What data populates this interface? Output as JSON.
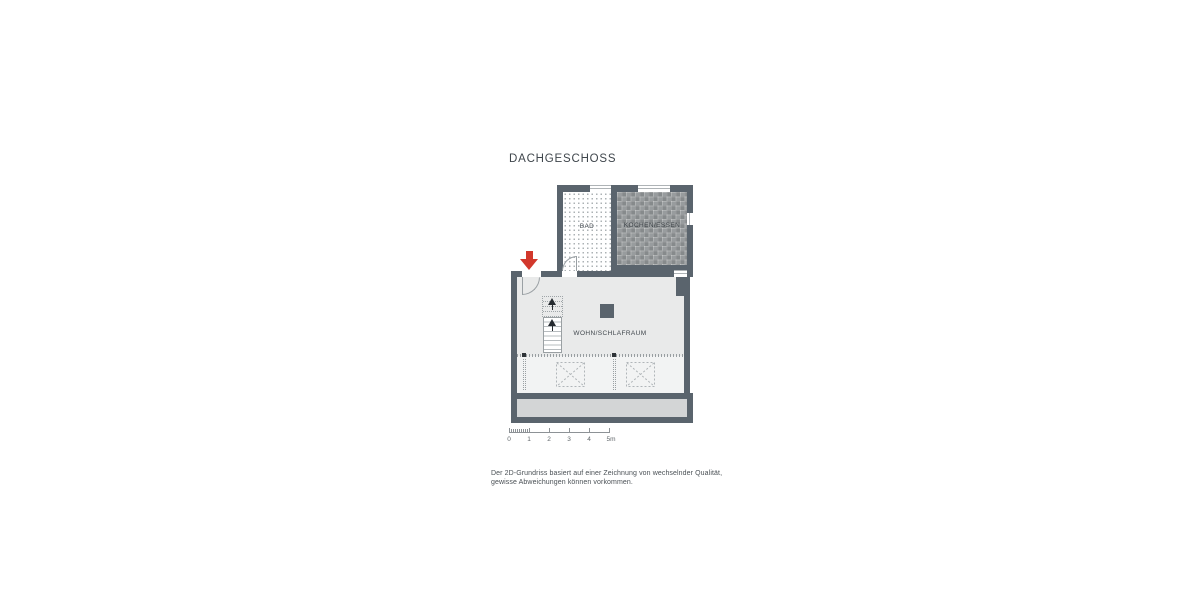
{
  "title": "DACHGESCHOSS",
  "colors": {
    "wall": "#5a646d",
    "floor_main": "#e9eaea",
    "floor_under_roof": "#f2f3f3",
    "floor_balcony": "#d3d5d6",
    "kitchen_tile_base": "#989c9e",
    "accent_red": "#d2382c",
    "line": "#9aa0a4",
    "text": "#3f464c"
  },
  "floorplan": {
    "rooms": [
      {
        "name": "bad",
        "label": "BAD"
      },
      {
        "name": "kochen-essen",
        "label": "KOCHEN/ESSEN"
      },
      {
        "name": "wohn-schlafraum",
        "label": "WOHN/SCHLAFRAUM"
      }
    ],
    "features": {
      "entrance_marker": "red-arrow-down",
      "stairs_direction": "up",
      "skylight_count": 2
    }
  },
  "scale_bar": {
    "tick_labels": [
      "0",
      "1",
      "2",
      "3",
      "4",
      "5m"
    ]
  },
  "disclaimer": {
    "line1": "Der 2D-Grundriss basiert auf einer Zeichnung von wechselnder Qualität,",
    "line2": "gewisse Abweichungen können vorkommen."
  }
}
